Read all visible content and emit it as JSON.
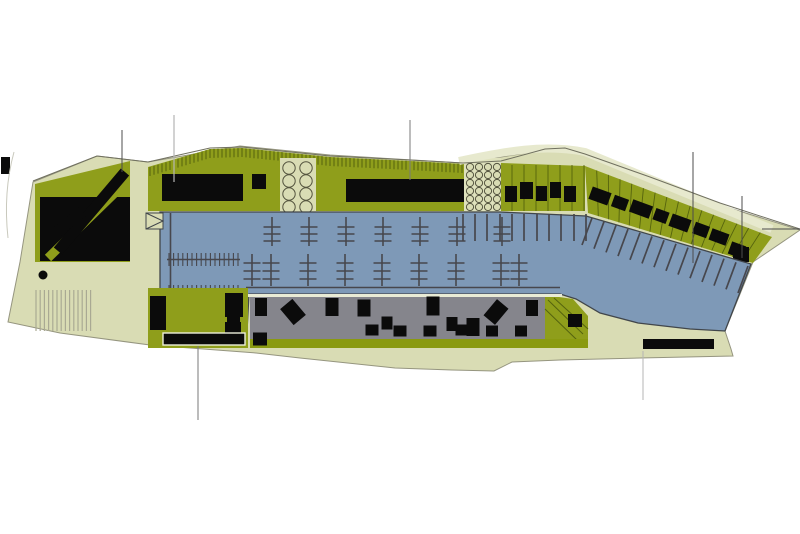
{
  "plan": {
    "kind": "marina-masterplan-site-plan",
    "palette": {
      "background": "#ffffff",
      "land": "#d9dcb4",
      "land_light": "#e7e9ce",
      "green": "#8f9e1b",
      "olive_strip": "#8a9a10",
      "water": "#7e99b7",
      "water_edge": "#41464b",
      "yard_gray": "#85858c",
      "building_black": "#0b0b0b",
      "pier": "#47474d",
      "plot_line": "#55630e",
      "outline": "#70705f",
      "leader_dark": "#4c4c4c",
      "leader_mid": "#7a7a7a",
      "leader_light": "#b5b5b5",
      "tree_stroke": "#54543f",
      "stripe": "#a9a993"
    },
    "hatch_top": {
      "points": [
        [
          150,
          167
        ],
        [
          210,
          149
        ],
        [
          242,
          148
        ],
        [
          330,
          157
        ],
        [
          410,
          161
        ],
        [
          462,
          164
        ]
      ],
      "step": 4,
      "len": 9
    },
    "ramp_stripes": {
      "x1": 36,
      "x2": 94,
      "step": 4.2,
      "y1": 290,
      "y2": 331
    },
    "trees": {
      "large": {
        "cols": [
          289,
          306
        ],
        "rows": [
          168,
          181,
          194,
          207
        ],
        "r": 6.2
      },
      "small": {
        "cols": [
          470,
          479,
          488,
          497
        ],
        "rows": [
          167,
          175,
          183,
          191,
          199,
          207
        ],
        "r": 3.6
      }
    },
    "band1": {
      "x1": 501,
      "x2": 585,
      "top": 165,
      "bottom": 211,
      "step": 12,
      "buildings": [
        [
          505,
          186,
          12,
          16
        ],
        [
          520,
          182,
          13,
          17
        ],
        [
          536,
          186,
          11,
          15
        ],
        [
          550,
          182,
          11,
          16
        ],
        [
          564,
          186,
          12,
          16
        ]
      ]
    },
    "band2": {
      "tl": [
        585,
        166
      ],
      "tr": [
        772,
        237
      ],
      "br": [
        753,
        263
      ],
      "bl": [
        588,
        213
      ],
      "lines": 16,
      "buildings": [
        [
          600,
          196,
          20,
          13,
          20
        ],
        [
          620,
          203,
          15,
          12,
          20
        ],
        [
          641,
          209,
          21,
          13,
          20
        ],
        [
          661,
          216,
          14,
          12,
          20
        ],
        [
          680,
          223,
          20,
          13,
          20
        ],
        [
          701,
          230,
          15,
          12,
          20
        ],
        [
          719,
          237,
          18,
          12,
          20
        ],
        [
          737,
          250,
          15,
          13,
          20
        ]
      ],
      "end_square": [
        733,
        247,
        16,
        15
      ]
    },
    "piers": {
      "rowA": {
        "xs": [
          272,
          309,
          346,
          383,
          420,
          457,
          502
        ],
        "y1": 217,
        "y2": 246,
        "ticks": [
          227,
          234,
          241
        ],
        "half": 8.5
      },
      "rowB": {
        "xs": [
          252,
          271,
          308,
          345,
          382,
          419,
          456,
          501,
          519
        ],
        "y1": 254,
        "y2": 286,
        "ticks": [
          263,
          271,
          279
        ],
        "half": 8.5
      },
      "walkwayB": {
        "y": 287.5,
        "x1": 246,
        "x2": 560
      },
      "combs": {
        "x1": 167,
        "x2": 240,
        "ys": [
          259.5,
          291.5
        ],
        "tick": 6.5,
        "step": 4.6,
        "spine_x": 170.5,
        "spine_y1": 213,
        "spine_y2": 296
      },
      "dock_ticks": {
        "y": 325.5,
        "x1": 207,
        "x2": 247,
        "step": 4.8,
        "tick_h": 8
      },
      "fingers_v": {
        "xs": [
          463,
          475,
          487,
          500,
          512,
          524,
          537,
          549,
          561,
          574,
          586
        ],
        "y1": 214,
        "y2": 241
      },
      "fingers_a": {
        "p1": [
          592,
          218
        ],
        "p2": [
          748,
          266
        ],
        "count": 14,
        "dx": -10,
        "dy": 27
      }
    },
    "top_band_buildings": [
      [
        162,
        174,
        81,
        27
      ],
      [
        252,
        174,
        14,
        15
      ],
      [
        346,
        179,
        118,
        23
      ]
    ],
    "courtyard_buildings": [
      [
        150,
        296,
        16,
        34
      ],
      [
        225,
        293,
        18,
        24
      ],
      [
        227,
        316,
        13,
        7
      ],
      [
        225,
        322,
        16,
        19
      ]
    ],
    "boats": [
      [
        261,
        307,
        12,
        18,
        0
      ],
      [
        293,
        312,
        16,
        21,
        -40
      ],
      [
        332,
        307,
        13,
        18,
        0
      ],
      [
        364,
        308,
        13,
        17,
        0
      ],
      [
        387,
        323,
        11,
        13,
        0
      ],
      [
        433,
        306,
        13,
        19,
        0
      ],
      [
        452,
        324,
        11,
        14,
        0
      ],
      [
        473,
        327,
        13,
        18,
        0
      ],
      [
        496,
        312,
        15,
        21,
        40
      ],
      [
        532,
        308,
        12,
        16,
        0
      ],
      [
        372,
        330,
        13,
        11,
        0
      ],
      [
        400,
        331,
        13,
        11,
        0
      ],
      [
        430,
        331,
        13,
        11,
        0
      ],
      [
        462,
        330,
        13,
        11,
        0
      ],
      [
        492,
        331,
        12,
        11,
        0
      ],
      [
        521,
        331,
        12,
        11,
        0
      ],
      [
        260,
        339,
        14,
        13,
        0
      ]
    ],
    "patch": {
      "poly": "545,295 573,299 588,316 588,340 545,340",
      "lines": [
        [
          548,
          300,
          583,
          334
        ],
        [
          554,
          298,
          588,
          329
        ],
        [
          545,
          309,
          577,
          340
        ]
      ],
      "square": [
        568,
        314,
        14,
        13
      ]
    },
    "bars": {
      "bottom_left": [
        163,
        333,
        82,
        12
      ],
      "bottom_left_sq": [
        253,
        333,
        14,
        12
      ],
      "bottom_right": [
        643,
        339,
        71,
        10
      ]
    },
    "leaders": [
      {
        "x1": 122,
        "y1": 130,
        "x2": 122,
        "y2": 172,
        "c": "leader_dark",
        "w": 1
      },
      {
        "x1": 174,
        "y1": 115,
        "x2": 174,
        "y2": 182,
        "c": "leader_light",
        "w": 1.2
      },
      {
        "x1": 410,
        "y1": 120,
        "x2": 410,
        "y2": 180,
        "c": "leader_mid",
        "w": 1
      },
      {
        "x1": 693,
        "y1": 152,
        "x2": 693,
        "y2": 263,
        "c": "leader_dark",
        "w": 1
      },
      {
        "x1": 742,
        "y1": 196,
        "x2": 742,
        "y2": 258,
        "c": "leader_dark",
        "w": 1
      },
      {
        "x1": 762,
        "y1": 229,
        "x2": 800,
        "y2": 229,
        "c": "leader_dark",
        "w": 1
      },
      {
        "x1": 198,
        "y1": 346,
        "x2": 198,
        "y2": 420,
        "c": "leader_mid",
        "w": 1
      },
      {
        "x1": 643,
        "y1": 351,
        "x2": 643,
        "y2": 400,
        "c": "leader_light",
        "w": 1
      }
    ]
  }
}
